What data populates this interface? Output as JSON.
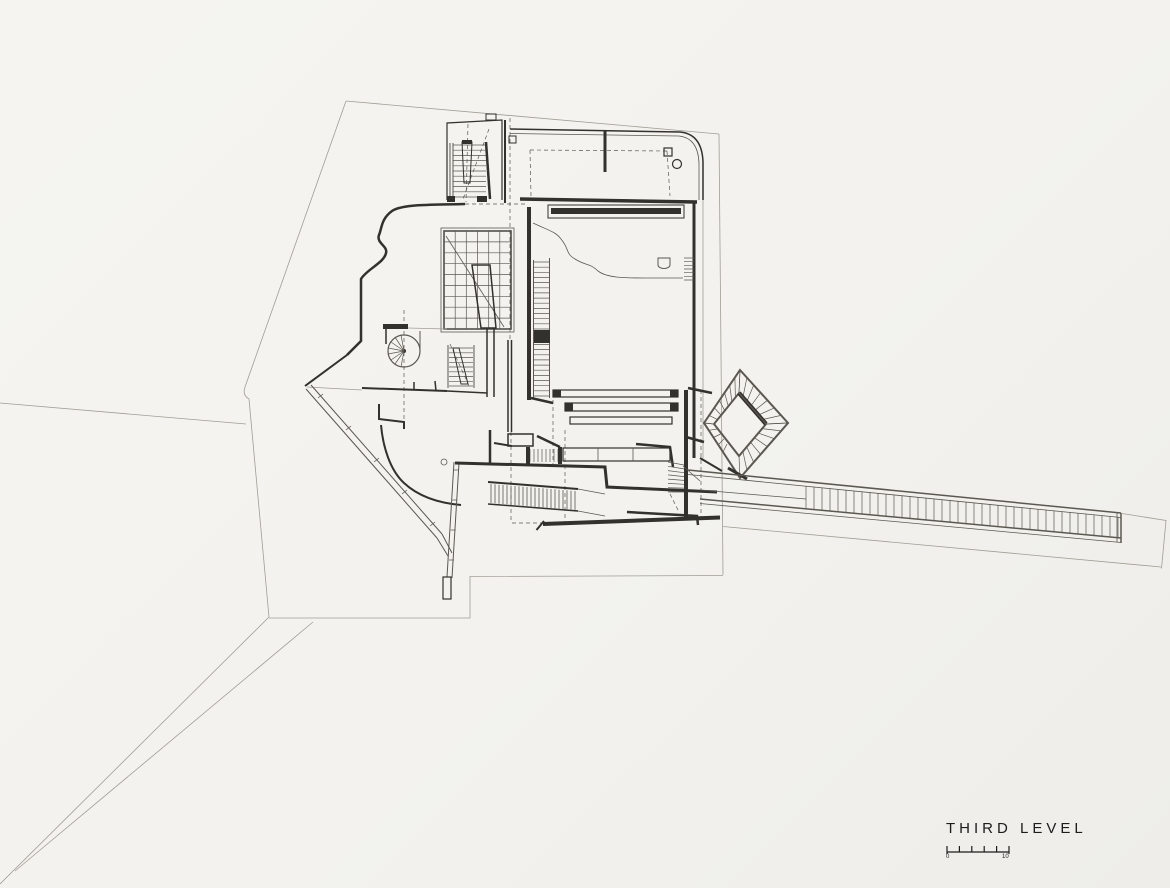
{
  "drawing": {
    "title": "THIRD LEVEL",
    "scale": {
      "start": "0",
      "end": "10"
    }
  },
  "palette": {
    "paper": "#f3f2ee",
    "ink_heavy": "#33312d",
    "ink_medium": "#5a5850",
    "ink_light": "#a09d94"
  }
}
